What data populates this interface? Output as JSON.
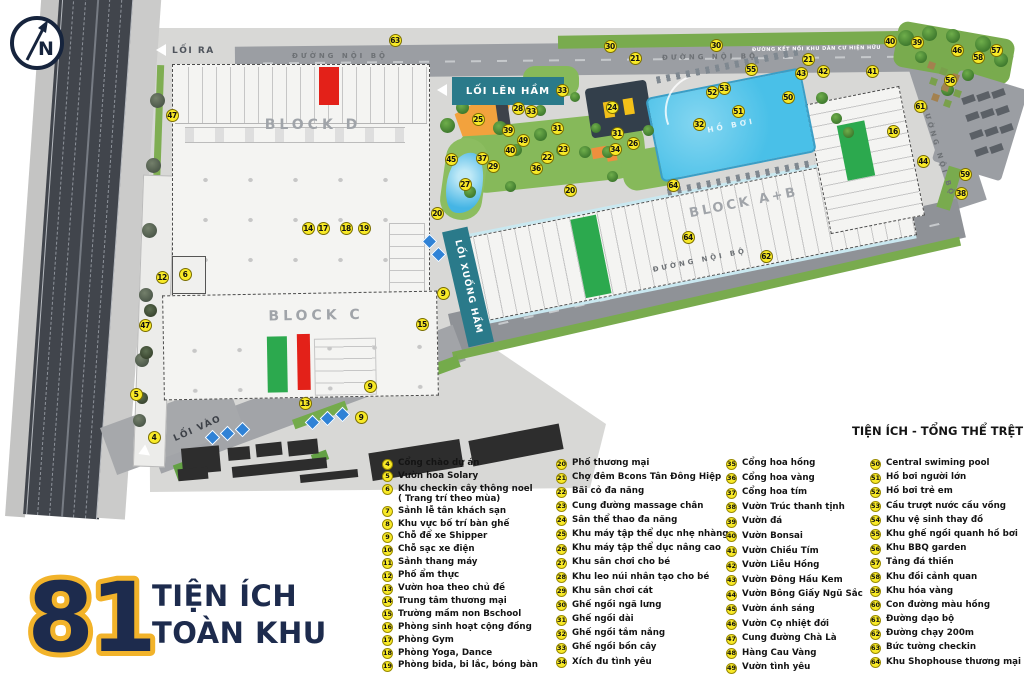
{
  "compass": {
    "letter": "N"
  },
  "title": {
    "number": "81",
    "line1": "TIỆN ÍCH",
    "line2": "TOÀN KHU"
  },
  "map": {
    "road_label": "ĐƯỜNG NỘI BỘ",
    "connector_label": "ĐƯỜNG KẾT NỐI KHU DÂN CƯ HIỆN HỮU",
    "exit_label": "LỐI RA",
    "entry_label": "LỐI VÀO",
    "ramp_up_label": "LỐI LÊN HẦM",
    "ramp_down_label": "LỐI XUỐNG HẦM",
    "block_d": "BLOCK D",
    "block_c": "BLOCK C",
    "block_ab": "BLOCK A+B",
    "pool_label": "HỒ BƠI"
  },
  "markers": [
    {
      "n": 63,
      "x": 395,
      "y": 40
    },
    {
      "n": 30,
      "x": 610,
      "y": 46
    },
    {
      "n": 30,
      "x": 716,
      "y": 45
    },
    {
      "n": 21,
      "x": 635,
      "y": 58
    },
    {
      "n": 21,
      "x": 808,
      "y": 59
    },
    {
      "n": 40,
      "x": 890,
      "y": 41
    },
    {
      "n": 39,
      "x": 917,
      "y": 42
    },
    {
      "n": 46,
      "x": 957,
      "y": 50
    },
    {
      "n": 57,
      "x": 996,
      "y": 50
    },
    {
      "n": 58,
      "x": 978,
      "y": 57
    },
    {
      "n": 41,
      "x": 872,
      "y": 71
    },
    {
      "n": 42,
      "x": 823,
      "y": 71
    },
    {
      "n": 43,
      "x": 801,
      "y": 73
    },
    {
      "n": 55,
      "x": 751,
      "y": 69
    },
    {
      "n": 53,
      "x": 724,
      "y": 88
    },
    {
      "n": 52,
      "x": 712,
      "y": 92
    },
    {
      "n": 50,
      "x": 788,
      "y": 97
    },
    {
      "n": 51,
      "x": 738,
      "y": 111
    },
    {
      "n": 56,
      "x": 950,
      "y": 80
    },
    {
      "n": 61,
      "x": 920,
      "y": 106
    },
    {
      "n": 16,
      "x": 893,
      "y": 131
    },
    {
      "n": 44,
      "x": 923,
      "y": 161
    },
    {
      "n": 59,
      "x": 965,
      "y": 174
    },
    {
      "n": 38,
      "x": 961,
      "y": 193
    },
    {
      "n": 32,
      "x": 699,
      "y": 124
    },
    {
      "n": 26,
      "x": 633,
      "y": 143
    },
    {
      "n": 33,
      "x": 562,
      "y": 90
    },
    {
      "n": 28,
      "x": 518,
      "y": 108
    },
    {
      "n": 33,
      "x": 531,
      "y": 111
    },
    {
      "n": 25,
      "x": 478,
      "y": 119
    },
    {
      "n": 24,
      "x": 612,
      "y": 107
    },
    {
      "n": 39,
      "x": 508,
      "y": 130
    },
    {
      "n": 49,
      "x": 523,
      "y": 140
    },
    {
      "n": 40,
      "x": 510,
      "y": 150
    },
    {
      "n": 31,
      "x": 557,
      "y": 128
    },
    {
      "n": 23,
      "x": 563,
      "y": 149
    },
    {
      "n": 22,
      "x": 547,
      "y": 157
    },
    {
      "n": 36,
      "x": 536,
      "y": 168
    },
    {
      "n": 29,
      "x": 493,
      "y": 166
    },
    {
      "n": 45,
      "x": 451,
      "y": 159
    },
    {
      "n": 37,
      "x": 482,
      "y": 158
    },
    {
      "n": 27,
      "x": 465,
      "y": 184
    },
    {
      "n": 31,
      "x": 617,
      "y": 133
    },
    {
      "n": 34,
      "x": 615,
      "y": 149
    },
    {
      "n": 20,
      "x": 570,
      "y": 190
    },
    {
      "n": 20,
      "x": 437,
      "y": 213
    },
    {
      "n": 64,
      "x": 673,
      "y": 185
    },
    {
      "n": 64,
      "x": 688,
      "y": 237
    },
    {
      "n": 62,
      "x": 766,
      "y": 256
    },
    {
      "n": 14,
      "x": 308,
      "y": 228
    },
    {
      "n": 17,
      "x": 323,
      "y": 228
    },
    {
      "n": 18,
      "x": 346,
      "y": 228
    },
    {
      "n": 19,
      "x": 364,
      "y": 228
    },
    {
      "n": 47,
      "x": 172,
      "y": 115
    },
    {
      "n": 47,
      "x": 145,
      "y": 325
    },
    {
      "n": 12,
      "x": 162,
      "y": 277
    },
    {
      "n": 6,
      "x": 185,
      "y": 274
    },
    {
      "n": 5,
      "x": 136,
      "y": 394
    },
    {
      "n": 4,
      "x": 154,
      "y": 437
    },
    {
      "n": 13,
      "x": 305,
      "y": 403
    },
    {
      "n": 9,
      "x": 443,
      "y": 293
    },
    {
      "n": 9,
      "x": 370,
      "y": 386
    },
    {
      "n": 9,
      "x": 361,
      "y": 417
    },
    {
      "n": 15,
      "x": 422,
      "y": 324
    }
  ],
  "legend": {
    "heading": "TIỆN ÍCH - TỔNG THỂ TRỆT",
    "columns": [
      [
        {
          "n": 4,
          "label": "Cổng chào dự án"
        },
        {
          "n": 5,
          "label": "Vườn hoa Solary"
        },
        {
          "n": 6,
          "label": "Khu checkin cây thông noel\n( Trang trí theo mùa)"
        },
        {
          "n": 7,
          "label": "Sảnh lễ tân khách sạn"
        },
        {
          "n": 8,
          "label": "Khu vực bố trí bàn ghế"
        },
        {
          "n": 9,
          "label": "Chỗ để xe Shipper"
        },
        {
          "n": 10,
          "label": "Chỗ sạc xe điện"
        },
        {
          "n": 11,
          "label": "Sảnh thang máy"
        },
        {
          "n": 12,
          "label": "Phố ẩm thực"
        },
        {
          "n": 13,
          "label": "Vườn hoa theo chủ đề"
        },
        {
          "n": 14,
          "label": "Trung tâm thương mại"
        },
        {
          "n": 15,
          "label": "Trường mầm non Bschool"
        },
        {
          "n": 16,
          "label": "Phòng sinh hoạt cộng đồng"
        },
        {
          "n": 17,
          "label": "Phòng Gym"
        },
        {
          "n": 18,
          "label": "Phòng Yoga, Dance"
        },
        {
          "n": 19,
          "label": "Phòng bida, bi lắc, bóng bàn"
        }
      ],
      [
        {
          "n": 20,
          "label": "Phố thương mại"
        },
        {
          "n": 21,
          "label": "Chợ đêm Bcons Tân Đông Hiệp"
        },
        {
          "n": 22,
          "label": "Bãi cỏ đa năng"
        },
        {
          "n": 23,
          "label": "Cung đường massage chân"
        },
        {
          "n": 24,
          "label": "Sân thể thao đa năng"
        },
        {
          "n": 25,
          "label": "Khu máy tập thể dục nhẹ nhàng"
        },
        {
          "n": 26,
          "label": "Khu máy tập thể dục nâng cao"
        },
        {
          "n": 27,
          "label": "Khu sân chơi cho bé"
        },
        {
          "n": 28,
          "label": "Khu leo núi nhân tạo cho bé"
        },
        {
          "n": 29,
          "label": "Khu sân chơi cát"
        },
        {
          "n": 30,
          "label": "Ghế ngồi ngã lưng"
        },
        {
          "n": 31,
          "label": "Ghế ngồi dài"
        },
        {
          "n": 32,
          "label": "Ghế ngồi tắm nắng"
        },
        {
          "n": 33,
          "label": "Ghế ngồi bồn cây"
        },
        {
          "n": 34,
          "label": "Xích đu tình yêu"
        }
      ],
      [
        {
          "n": 35,
          "label": "Cổng hoa hồng"
        },
        {
          "n": 36,
          "label": "Cổng hoa vàng"
        },
        {
          "n": 37,
          "label": "Cổng hoa tím"
        },
        {
          "n": 38,
          "label": "Vườn Trúc thanh tịnh"
        },
        {
          "n": 39,
          "label": "Vườn đá"
        },
        {
          "n": 40,
          "label": "Vườn Bonsai"
        },
        {
          "n": 41,
          "label": "Vườn Chiều Tím"
        },
        {
          "n": 42,
          "label": "Vườn Liễu Hồng"
        },
        {
          "n": 43,
          "label": "Vườn Đông Hầu Kem"
        },
        {
          "n": 44,
          "label": "Vườn Bông Giấy Ngũ Sắc"
        },
        {
          "n": 45,
          "label": "Vườn ánh sáng"
        },
        {
          "n": 46,
          "label": "Vườn Cọ nhiệt đới"
        },
        {
          "n": 47,
          "label": "Cung đường Chà Là"
        },
        {
          "n": 48,
          "label": "Hàng Cau Vàng"
        },
        {
          "n": 49,
          "label": "Vườn tình yêu"
        }
      ],
      [
        {
          "n": 50,
          "label": "Central swiming pool"
        },
        {
          "n": 51,
          "label": "Hồ bơi người lớn"
        },
        {
          "n": 52,
          "label": "Hồ bơi trẻ em"
        },
        {
          "n": 53,
          "label": "Cầu trượt nước cầu vồng"
        },
        {
          "n": 54,
          "label": "Khu vệ sinh thay đồ"
        },
        {
          "n": 55,
          "label": "Khu ghế ngồi quanh hồ bơi"
        },
        {
          "n": 56,
          "label": "Khu BBQ garden"
        },
        {
          "n": 57,
          "label": "Tảng đá thiền"
        },
        {
          "n": 58,
          "label": "Khu đồi cảnh quan"
        },
        {
          "n": 59,
          "label": "Khu hóa vàng"
        },
        {
          "n": 60,
          "label": "Con đường màu hồng"
        },
        {
          "n": 61,
          "label": "Đường dạo bộ"
        },
        {
          "n": 62,
          "label": "Đường chạy 200m"
        },
        {
          "n": 63,
          "label": "Bức tường checkin"
        },
        {
          "n": 64,
          "label": "Khu Shophouse thương mại"
        }
      ]
    ]
  }
}
